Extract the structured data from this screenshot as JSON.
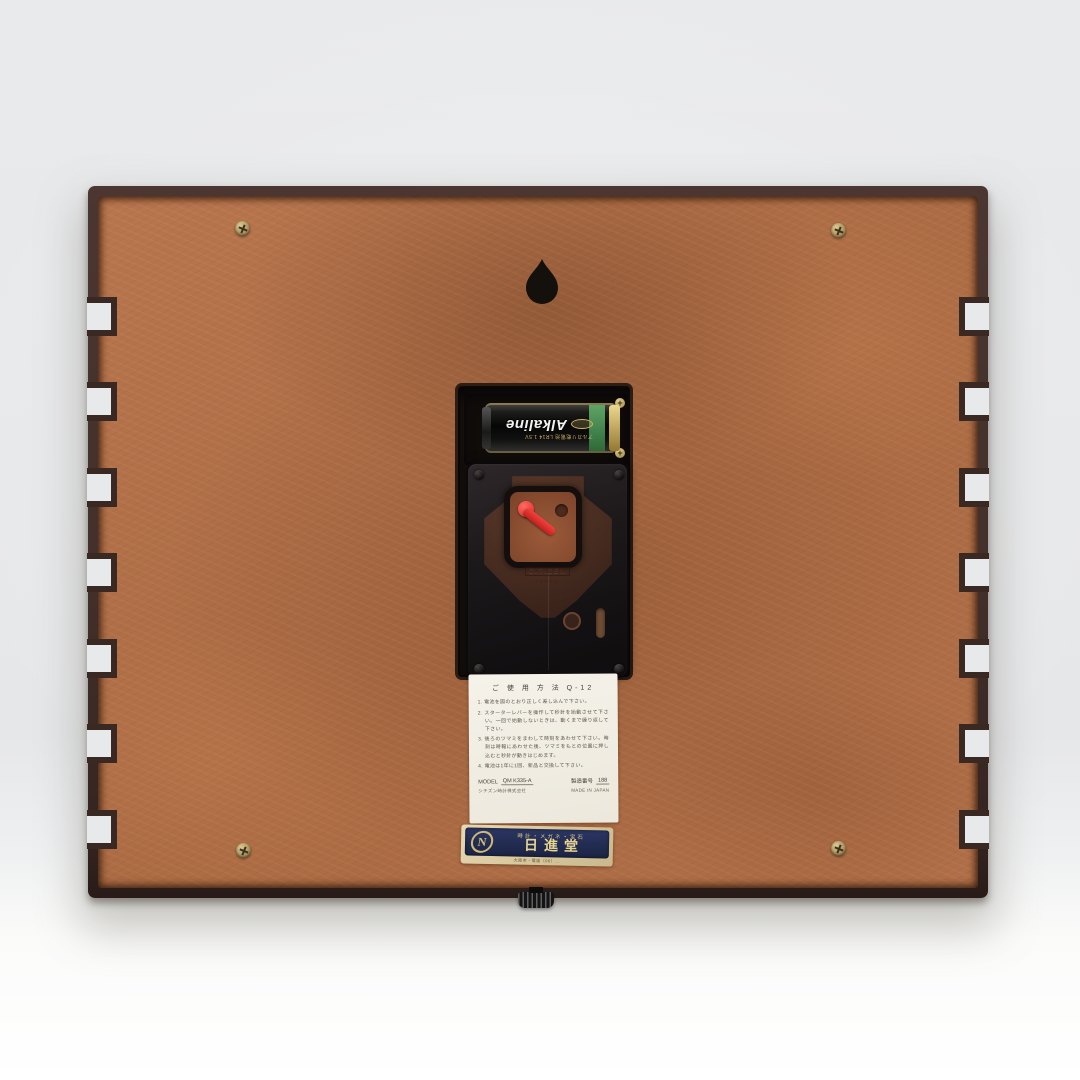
{
  "scene": {
    "subject": "back of a wooden quartz wall clock standing on a white surface",
    "colors": {
      "backdrop": "#e9eaec",
      "surface": "#ffffff",
      "frame_wood": "#43302b",
      "backboard": "#ae6d46",
      "lever_red": "#e0312d",
      "label_navy": "#212a4e",
      "label_gold": "#e6d28e",
      "battery_green": "#3e8049",
      "brass": "#c9b48a"
    }
  },
  "clock": {
    "battery": {
      "brand": "Alkaline",
      "spec": "アルカリ乾電池 LR14 1.5V"
    },
    "movement": {
      "embossed_brand": "CITIZEN",
      "embossed_origin": "JAPAN"
    },
    "instruction_label": {
      "title": "ご 使 用 方 法  Q-12",
      "items": [
        "1. 電池を図のとおり正しく差し込んで下さい。",
        "2. スターターレバーを操作して秒針を始動させて下さい。一回で始動しないときは、動くまで繰り返して下さい。",
        "3. 後ろのツマミをまわして時刻をあわせて下さい。時刻は時報にあわせた後、ツマミをもとの位置に押し込むと秒針が動きはじめます。",
        "4. 電池は1年に1回、新品と交換して下さい。"
      ],
      "model_label": "MODEL",
      "model_value": "QM K335-A",
      "serial_label": "製造番号",
      "serial_value": "188",
      "company": "シチズン時計株式会社",
      "made_in": "MADE IN JAPAN"
    },
    "retailer_label": {
      "logo_letter": "N",
      "tagline": "時計・メガネ・宝石",
      "name": "日進堂",
      "address_line": "大阪市・電話（06）…"
    }
  }
}
